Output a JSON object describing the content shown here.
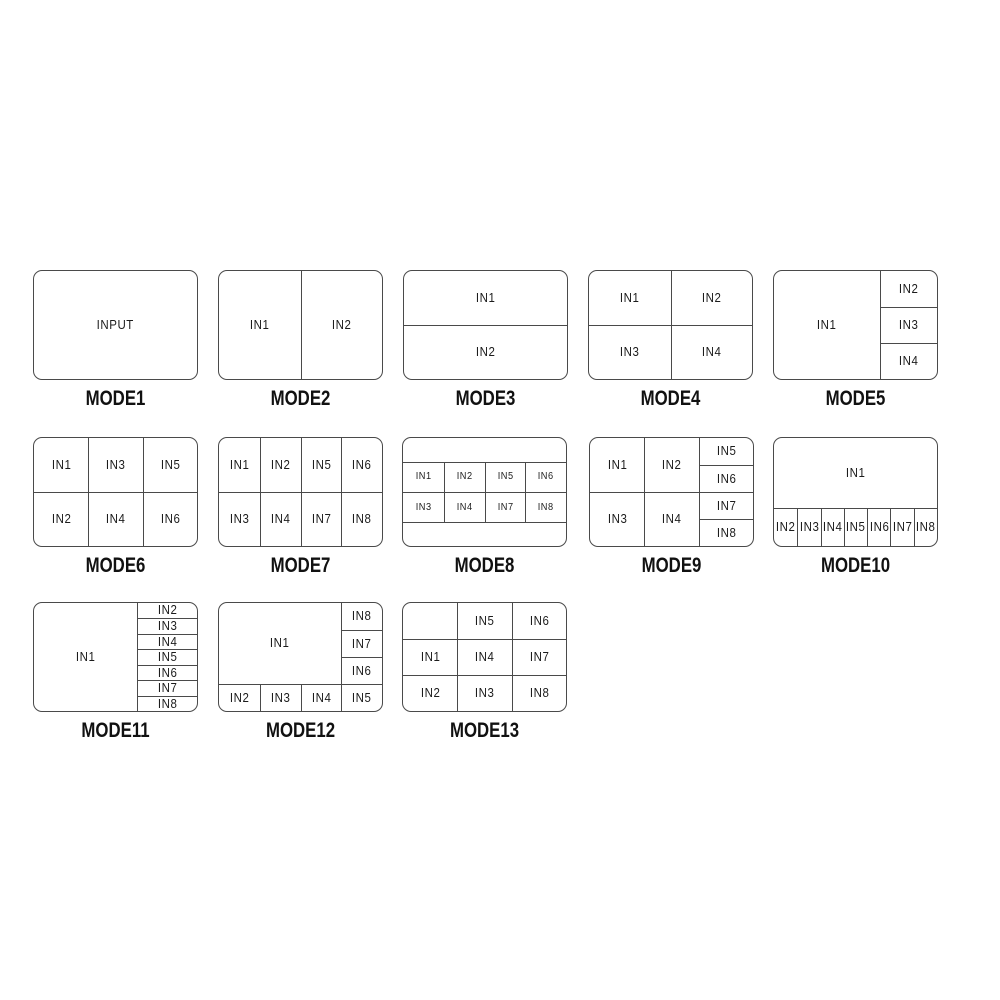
{
  "modes": [
    {
      "label": "MODE1",
      "cells": [
        {
          "label": "INPUT",
          "x": 0,
          "y": 0,
          "w": 100,
          "h": 100
        }
      ]
    },
    {
      "label": "MODE2",
      "cells": [
        {
          "label": "IN1",
          "x": 0,
          "y": 0,
          "w": 50,
          "h": 100
        },
        {
          "label": "IN2",
          "x": 50,
          "y": 0,
          "w": 50,
          "h": 100
        }
      ]
    },
    {
      "label": "MODE3",
      "cells": [
        {
          "label": "IN1",
          "x": 0,
          "y": 0,
          "w": 100,
          "h": 50
        },
        {
          "label": "IN2",
          "x": 0,
          "y": 50,
          "w": 100,
          "h": 50
        }
      ]
    },
    {
      "label": "MODE4",
      "cells": [
        {
          "label": "IN1",
          "x": 0,
          "y": 0,
          "w": 50,
          "h": 50
        },
        {
          "label": "IN2",
          "x": 50,
          "y": 0,
          "w": 50,
          "h": 50
        },
        {
          "label": "IN3",
          "x": 0,
          "y": 50,
          "w": 50,
          "h": 50
        },
        {
          "label": "IN4",
          "x": 50,
          "y": 50,
          "w": 50,
          "h": 50
        }
      ]
    },
    {
      "label": "MODE5",
      "cells": [
        {
          "label": "IN1",
          "x": 0,
          "y": 0,
          "w": 65,
          "h": 100
        },
        {
          "label": "IN2",
          "x": 65,
          "y": 0,
          "w": 35,
          "h": 33.33
        },
        {
          "label": "IN3",
          "x": 65,
          "y": 33.33,
          "w": 35,
          "h": 33.34
        },
        {
          "label": "IN4",
          "x": 65,
          "y": 66.67,
          "w": 35,
          "h": 33.33
        }
      ]
    },
    {
      "label": "MODE6",
      "cells": [
        {
          "label": "IN1",
          "x": 0,
          "y": 0,
          "w": 33.33,
          "h": 50
        },
        {
          "label": "IN3",
          "x": 33.33,
          "y": 0,
          "w": 33.34,
          "h": 50
        },
        {
          "label": "IN5",
          "x": 66.67,
          "y": 0,
          "w": 33.33,
          "h": 50
        },
        {
          "label": "IN2",
          "x": 0,
          "y": 50,
          "w": 33.33,
          "h": 50
        },
        {
          "label": "IN4",
          "x": 33.33,
          "y": 50,
          "w": 33.34,
          "h": 50
        },
        {
          "label": "IN6",
          "x": 66.67,
          "y": 50,
          "w": 33.33,
          "h": 50
        }
      ]
    },
    {
      "label": "MODE7",
      "cells": [
        {
          "label": "IN1",
          "x": 0,
          "y": 0,
          "w": 25,
          "h": 50
        },
        {
          "label": "IN2",
          "x": 25,
          "y": 0,
          "w": 25,
          "h": 50
        },
        {
          "label": "IN5",
          "x": 50,
          "y": 0,
          "w": 25,
          "h": 50
        },
        {
          "label": "IN6",
          "x": 75,
          "y": 0,
          "w": 25,
          "h": 50
        },
        {
          "label": "IN3",
          "x": 0,
          "y": 50,
          "w": 25,
          "h": 50
        },
        {
          "label": "IN4",
          "x": 25,
          "y": 50,
          "w": 25,
          "h": 50
        },
        {
          "label": "IN7",
          "x": 50,
          "y": 50,
          "w": 25,
          "h": 50
        },
        {
          "label": "IN8",
          "x": 75,
          "y": 50,
          "w": 25,
          "h": 50
        }
      ]
    },
    {
      "label": "MODE8",
      "small_labels": true,
      "cells": [
        {
          "label": "",
          "x": 0,
          "y": 0,
          "w": 100,
          "h": 22
        },
        {
          "label": "IN1",
          "x": 0,
          "y": 22,
          "w": 25,
          "h": 28
        },
        {
          "label": "IN2",
          "x": 25,
          "y": 22,
          "w": 25,
          "h": 28
        },
        {
          "label": "IN5",
          "x": 50,
          "y": 22,
          "w": 25,
          "h": 28
        },
        {
          "label": "IN6",
          "x": 75,
          "y": 22,
          "w": 25,
          "h": 28
        },
        {
          "label": "IN3",
          "x": 0,
          "y": 50,
          "w": 25,
          "h": 28
        },
        {
          "label": "IN4",
          "x": 25,
          "y": 50,
          "w": 25,
          "h": 28
        },
        {
          "label": "IN7",
          "x": 50,
          "y": 50,
          "w": 25,
          "h": 28
        },
        {
          "label": "IN8",
          "x": 75,
          "y": 50,
          "w": 25,
          "h": 28
        },
        {
          "label": "",
          "x": 0,
          "y": 78,
          "w": 100,
          "h": 22
        }
      ]
    },
    {
      "label": "MODE9",
      "cells": [
        {
          "label": "IN1",
          "x": 0,
          "y": 0,
          "w": 33.33,
          "h": 50
        },
        {
          "label": "IN2",
          "x": 33.33,
          "y": 0,
          "w": 33.34,
          "h": 50
        },
        {
          "label": "IN3",
          "x": 0,
          "y": 50,
          "w": 33.33,
          "h": 50
        },
        {
          "label": "IN4",
          "x": 33.33,
          "y": 50,
          "w": 33.34,
          "h": 50
        },
        {
          "label": "IN5",
          "x": 66.67,
          "y": 0,
          "w": 33.33,
          "h": 25
        },
        {
          "label": "IN6",
          "x": 66.67,
          "y": 25,
          "w": 33.33,
          "h": 25
        },
        {
          "label": "IN7",
          "x": 66.67,
          "y": 50,
          "w": 33.33,
          "h": 25
        },
        {
          "label": "IN8",
          "x": 66.67,
          "y": 75,
          "w": 33.33,
          "h": 25
        }
      ]
    },
    {
      "label": "MODE10",
      "cells": [
        {
          "label": "IN1",
          "x": 0,
          "y": 0,
          "w": 100,
          "h": 65
        },
        {
          "label": "IN2",
          "x": 0,
          "y": 65,
          "w": 14.28,
          "h": 35
        },
        {
          "label": "IN3",
          "x": 14.28,
          "y": 65,
          "w": 14.29,
          "h": 35
        },
        {
          "label": "IN4",
          "x": 28.57,
          "y": 65,
          "w": 14.29,
          "h": 35
        },
        {
          "label": "IN5",
          "x": 42.86,
          "y": 65,
          "w": 14.28,
          "h": 35
        },
        {
          "label": "IN6",
          "x": 57.14,
          "y": 65,
          "w": 14.29,
          "h": 35
        },
        {
          "label": "IN7",
          "x": 71.43,
          "y": 65,
          "w": 14.28,
          "h": 35
        },
        {
          "label": "IN8",
          "x": 85.71,
          "y": 65,
          "w": 14.29,
          "h": 35
        }
      ]
    },
    {
      "label": "MODE11",
      "cells": [
        {
          "label": "IN1",
          "x": 0,
          "y": 0,
          "w": 63,
          "h": 100
        },
        {
          "label": "IN2",
          "x": 63,
          "y": 0,
          "w": 37,
          "h": 14.28
        },
        {
          "label": "IN3",
          "x": 63,
          "y": 14.28,
          "w": 37,
          "h": 14.29
        },
        {
          "label": "IN4",
          "x": 63,
          "y": 28.57,
          "w": 37,
          "h": 14.29
        },
        {
          "label": "IN5",
          "x": 63,
          "y": 42.86,
          "w": 37,
          "h": 14.28
        },
        {
          "label": "IN6",
          "x": 63,
          "y": 57.14,
          "w": 37,
          "h": 14.29
        },
        {
          "label": "IN7",
          "x": 63,
          "y": 71.43,
          "w": 37,
          "h": 14.28
        },
        {
          "label": "IN8",
          "x": 63,
          "y": 85.71,
          "w": 37,
          "h": 14.29
        }
      ]
    },
    {
      "label": "MODE12",
      "cells": [
        {
          "label": "IN1",
          "x": 0,
          "y": 0,
          "w": 75,
          "h": 75
        },
        {
          "label": "IN8",
          "x": 75,
          "y": 0,
          "w": 25,
          "h": 25
        },
        {
          "label": "IN7",
          "x": 75,
          "y": 25,
          "w": 25,
          "h": 25
        },
        {
          "label": "IN6",
          "x": 75,
          "y": 50,
          "w": 25,
          "h": 25
        },
        {
          "label": "IN2",
          "x": 0,
          "y": 75,
          "w": 25,
          "h": 25
        },
        {
          "label": "IN3",
          "x": 25,
          "y": 75,
          "w": 25,
          "h": 25
        },
        {
          "label": "IN4",
          "x": 50,
          "y": 75,
          "w": 25,
          "h": 25
        },
        {
          "label": "IN5",
          "x": 75,
          "y": 75,
          "w": 25,
          "h": 25
        }
      ]
    },
    {
      "label": "MODE13",
      "cells": [
        {
          "label": "",
          "x": 0,
          "y": 0,
          "w": 33.33,
          "h": 33.33
        },
        {
          "label": "IN5",
          "x": 33.33,
          "y": 0,
          "w": 33.34,
          "h": 33.33
        },
        {
          "label": "IN6",
          "x": 66.67,
          "y": 0,
          "w": 33.33,
          "h": 33.33
        },
        {
          "label": "IN1",
          "x": 0,
          "y": 33.33,
          "w": 33.33,
          "h": 33.34
        },
        {
          "label": "IN4",
          "x": 33.33,
          "y": 33.33,
          "w": 33.34,
          "h": 33.34
        },
        {
          "label": "IN7",
          "x": 66.67,
          "y": 33.33,
          "w": 33.33,
          "h": 33.34
        },
        {
          "label": "IN2",
          "x": 0,
          "y": 66.67,
          "w": 33.33,
          "h": 33.33
        },
        {
          "label": "IN3",
          "x": 33.33,
          "y": 66.67,
          "w": 33.34,
          "h": 33.33
        },
        {
          "label": "IN8",
          "x": 66.67,
          "y": 66.67,
          "w": 33.33,
          "h": 33.33
        }
      ]
    }
  ]
}
